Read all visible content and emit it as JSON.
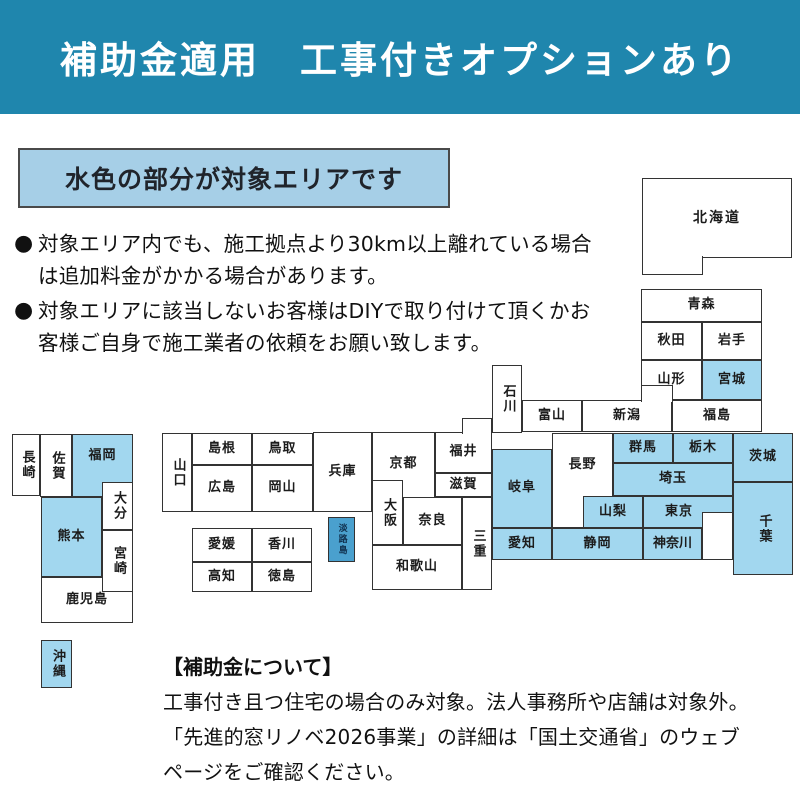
{
  "banner": {
    "title": "補助金適用　工事付きオプションあり"
  },
  "legend": {
    "title": "水色の部分が対象エリアです"
  },
  "notes": [
    {
      "lines": [
        "対象エリア内でも、施工拠点より30km以上離れている場合",
        "は追加料金がかかる場合があります。"
      ]
    },
    {
      "lines": [
        "対象エリアに該当しないお客様はDIYで取り付けて頂くかお",
        "客様ご自身で施工業者の依頼をお願い致します。"
      ]
    }
  ],
  "colors": {
    "banner_bg": "#1f86ad",
    "legend_bg": "#a6cfe7",
    "covered_fill": "#a2d7ef",
    "awaji_fill": "#4aa0ce",
    "not_covered_fill": "#ffffff",
    "border": "#333333"
  },
  "map": {
    "prefectures": [
      {
        "id": "hokkaido",
        "label": "北海道",
        "covered": false
      },
      {
        "id": "aomori",
        "label": "青森",
        "covered": false
      },
      {
        "id": "akita",
        "label": "秋田",
        "covered": false
      },
      {
        "id": "iwate",
        "label": "岩手",
        "covered": false
      },
      {
        "id": "yamagata",
        "label": "山形",
        "covered": false
      },
      {
        "id": "miyagi",
        "label": "宮城",
        "covered": true
      },
      {
        "id": "niigata",
        "label": "新潟",
        "covered": false
      },
      {
        "id": "fukushima",
        "label": "福島",
        "covered": false
      },
      {
        "id": "toyama",
        "label": "富山",
        "covered": false
      },
      {
        "id": "ishikawa",
        "label": "石川",
        "covered": false
      },
      {
        "id": "fukui",
        "label": "福井",
        "covered": false
      },
      {
        "id": "shiga",
        "label": "滋賀",
        "covered": false
      },
      {
        "id": "kyoto",
        "label": "京都",
        "covered": false
      },
      {
        "id": "osaka",
        "label": "大阪",
        "covered": false
      },
      {
        "id": "nara",
        "label": "奈良",
        "covered": false
      },
      {
        "id": "hyogo",
        "label": "兵庫",
        "covered": false
      },
      {
        "id": "wakayama",
        "label": "和歌山",
        "covered": false
      },
      {
        "id": "mie",
        "label": "三重",
        "covered": false
      },
      {
        "id": "awajishima",
        "label": "淡路島",
        "covered": true
      },
      {
        "id": "nagano",
        "label": "長野",
        "covered": false
      },
      {
        "id": "gifu",
        "label": "岐阜",
        "covered": true
      },
      {
        "id": "gunma",
        "label": "群馬",
        "covered": true
      },
      {
        "id": "tochigi",
        "label": "栃木",
        "covered": true
      },
      {
        "id": "ibaraki",
        "label": "茨城",
        "covered": true
      },
      {
        "id": "saitama",
        "label": "埼玉",
        "covered": true
      },
      {
        "id": "yamanashi",
        "label": "山梨",
        "covered": true
      },
      {
        "id": "tokyo",
        "label": "東京",
        "covered": true
      },
      {
        "id": "kanagawa",
        "label": "神奈川",
        "covered": true
      },
      {
        "id": "chiba",
        "label": "千葉",
        "covered": true
      },
      {
        "id": "shizuoka",
        "label": "静岡",
        "covered": true
      },
      {
        "id": "aichi",
        "label": "愛知",
        "covered": true
      },
      {
        "id": "yamaguchi",
        "label": "山口",
        "covered": false
      },
      {
        "id": "shimane",
        "label": "島根",
        "covered": false
      },
      {
        "id": "tottori",
        "label": "鳥取",
        "covered": false
      },
      {
        "id": "hiroshima",
        "label": "広島",
        "covered": false
      },
      {
        "id": "okayama",
        "label": "岡山",
        "covered": false
      },
      {
        "id": "ehime",
        "label": "愛媛",
        "covered": false
      },
      {
        "id": "kagawa",
        "label": "香川",
        "covered": false
      },
      {
        "id": "kochi",
        "label": "高知",
        "covered": false
      },
      {
        "id": "tokushima",
        "label": "徳島",
        "covered": false
      },
      {
        "id": "nagasaki",
        "label": "長崎",
        "covered": false
      },
      {
        "id": "saga",
        "label": "佐賀",
        "covered": false
      },
      {
        "id": "fukuoka",
        "label": "福岡",
        "covered": true
      },
      {
        "id": "oita",
        "label": "大分",
        "covered": false
      },
      {
        "id": "kumamoto",
        "label": "熊本",
        "covered": true
      },
      {
        "id": "kagoshima",
        "label": "鹿児島",
        "covered": false
      },
      {
        "id": "miyazaki",
        "label": "宮崎",
        "covered": false
      },
      {
        "id": "okinawa",
        "label": "沖縄",
        "covered": true
      }
    ]
  },
  "footer": {
    "heading": "【補助金について】",
    "lines": [
      "工事付き且つ住宅の場合のみ対象。法人事務所や店舗は対象外。",
      "「先進的窓リノベ2026事業」の詳細は「国土交通省」のウェブ",
      "ページをご確認ください。"
    ]
  }
}
